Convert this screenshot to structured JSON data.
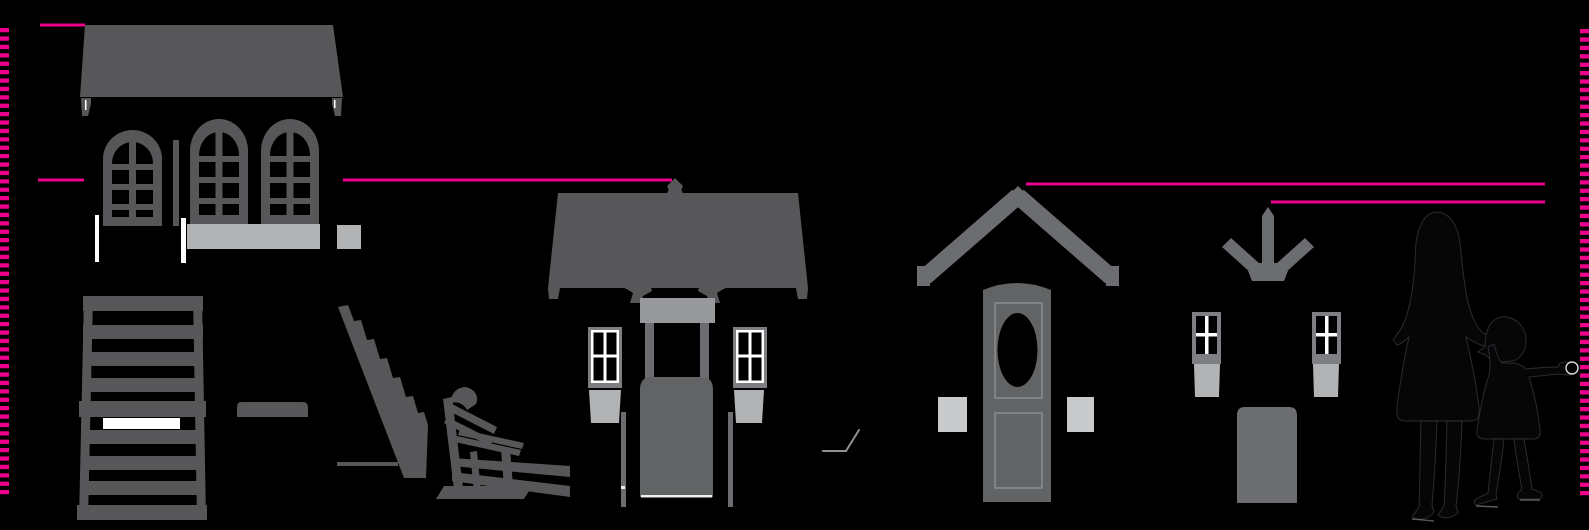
{
  "diagram": {
    "description": "Size comparison diagram of playhouse product silhouettes with adult and child figures for scale",
    "text_labels": []
  },
  "colors": {
    "background": "#000000",
    "magenta": "#ec008c",
    "silhouette": "#57575a",
    "silhouette_medium": "#6b6d70",
    "silhouette_door": "#616365",
    "silhouette_header": "#98999c",
    "silhouette_frame": "#7d7f82",
    "silhouette_light": "#b2b3b5",
    "silhouette_lighter": "#c9cacc",
    "white": "#ffffff",
    "figure": "#060606",
    "figure_outline": "#3c424b"
  },
  "rulers": {
    "left": {
      "x": 4.5,
      "y1": 28,
      "y2": 497,
      "thickness": 9,
      "dash": "4.3 4.1"
    },
    "right": {
      "x": 1584.5,
      "y1": 29,
      "y2": 497,
      "thickness": 9,
      "dash": "4.3 4.1"
    }
  },
  "height_lines": {
    "thickness": 3,
    "segments": [
      {
        "name": "height-line-playhouse-1-top",
        "x1": 40,
        "x2": 85,
        "y": 25
      },
      {
        "name": "height-line-playhouse-2-left-stub",
        "x1": 38,
        "x2": 84,
        "y": 180
      },
      {
        "name": "height-line-playhouse-2-top",
        "x1": 343,
        "x2": 672,
        "y": 180
      },
      {
        "name": "height-line-playhouse-3-top",
        "x1": 1026,
        "x2": 1545,
        "y": 184
      },
      {
        "name": "height-line-playhouse-4-top",
        "x1": 1271,
        "x2": 1545,
        "y": 202
      }
    ]
  },
  "items": [
    {
      "name": "two-story-cottage-playhouse",
      "kind": "playhouse silhouette, arched windows, wide hip roof"
    },
    {
      "name": "slatted-ladder-panel",
      "kind": "ladder / slat wall silhouette with white slat"
    },
    {
      "name": "step-plank",
      "kind": "small step board silhouette"
    },
    {
      "name": "stair-stringer",
      "kind": "diagonal stair silhouette"
    },
    {
      "name": "garden-bench",
      "kind": "angled bench silhouette with rails"
    },
    {
      "name": "gabled-porch-playhouse",
      "kind": "playhouse with A-frame dormer, door, two windows, planter boxes"
    },
    {
      "name": "chevron-roof-door-kit",
      "kind": "free-standing chevron roof over a door with oval window and side boxes"
    },
    {
      "name": "arrow-window-kit",
      "kind": "down-arrow bracket, two windows with boxes, base panel"
    },
    {
      "name": "adult-figure",
      "kind": "black silhouette of a woman, for scale"
    },
    {
      "name": "child-figure",
      "kind": "black silhouette of a child reaching right, for scale"
    }
  ]
}
